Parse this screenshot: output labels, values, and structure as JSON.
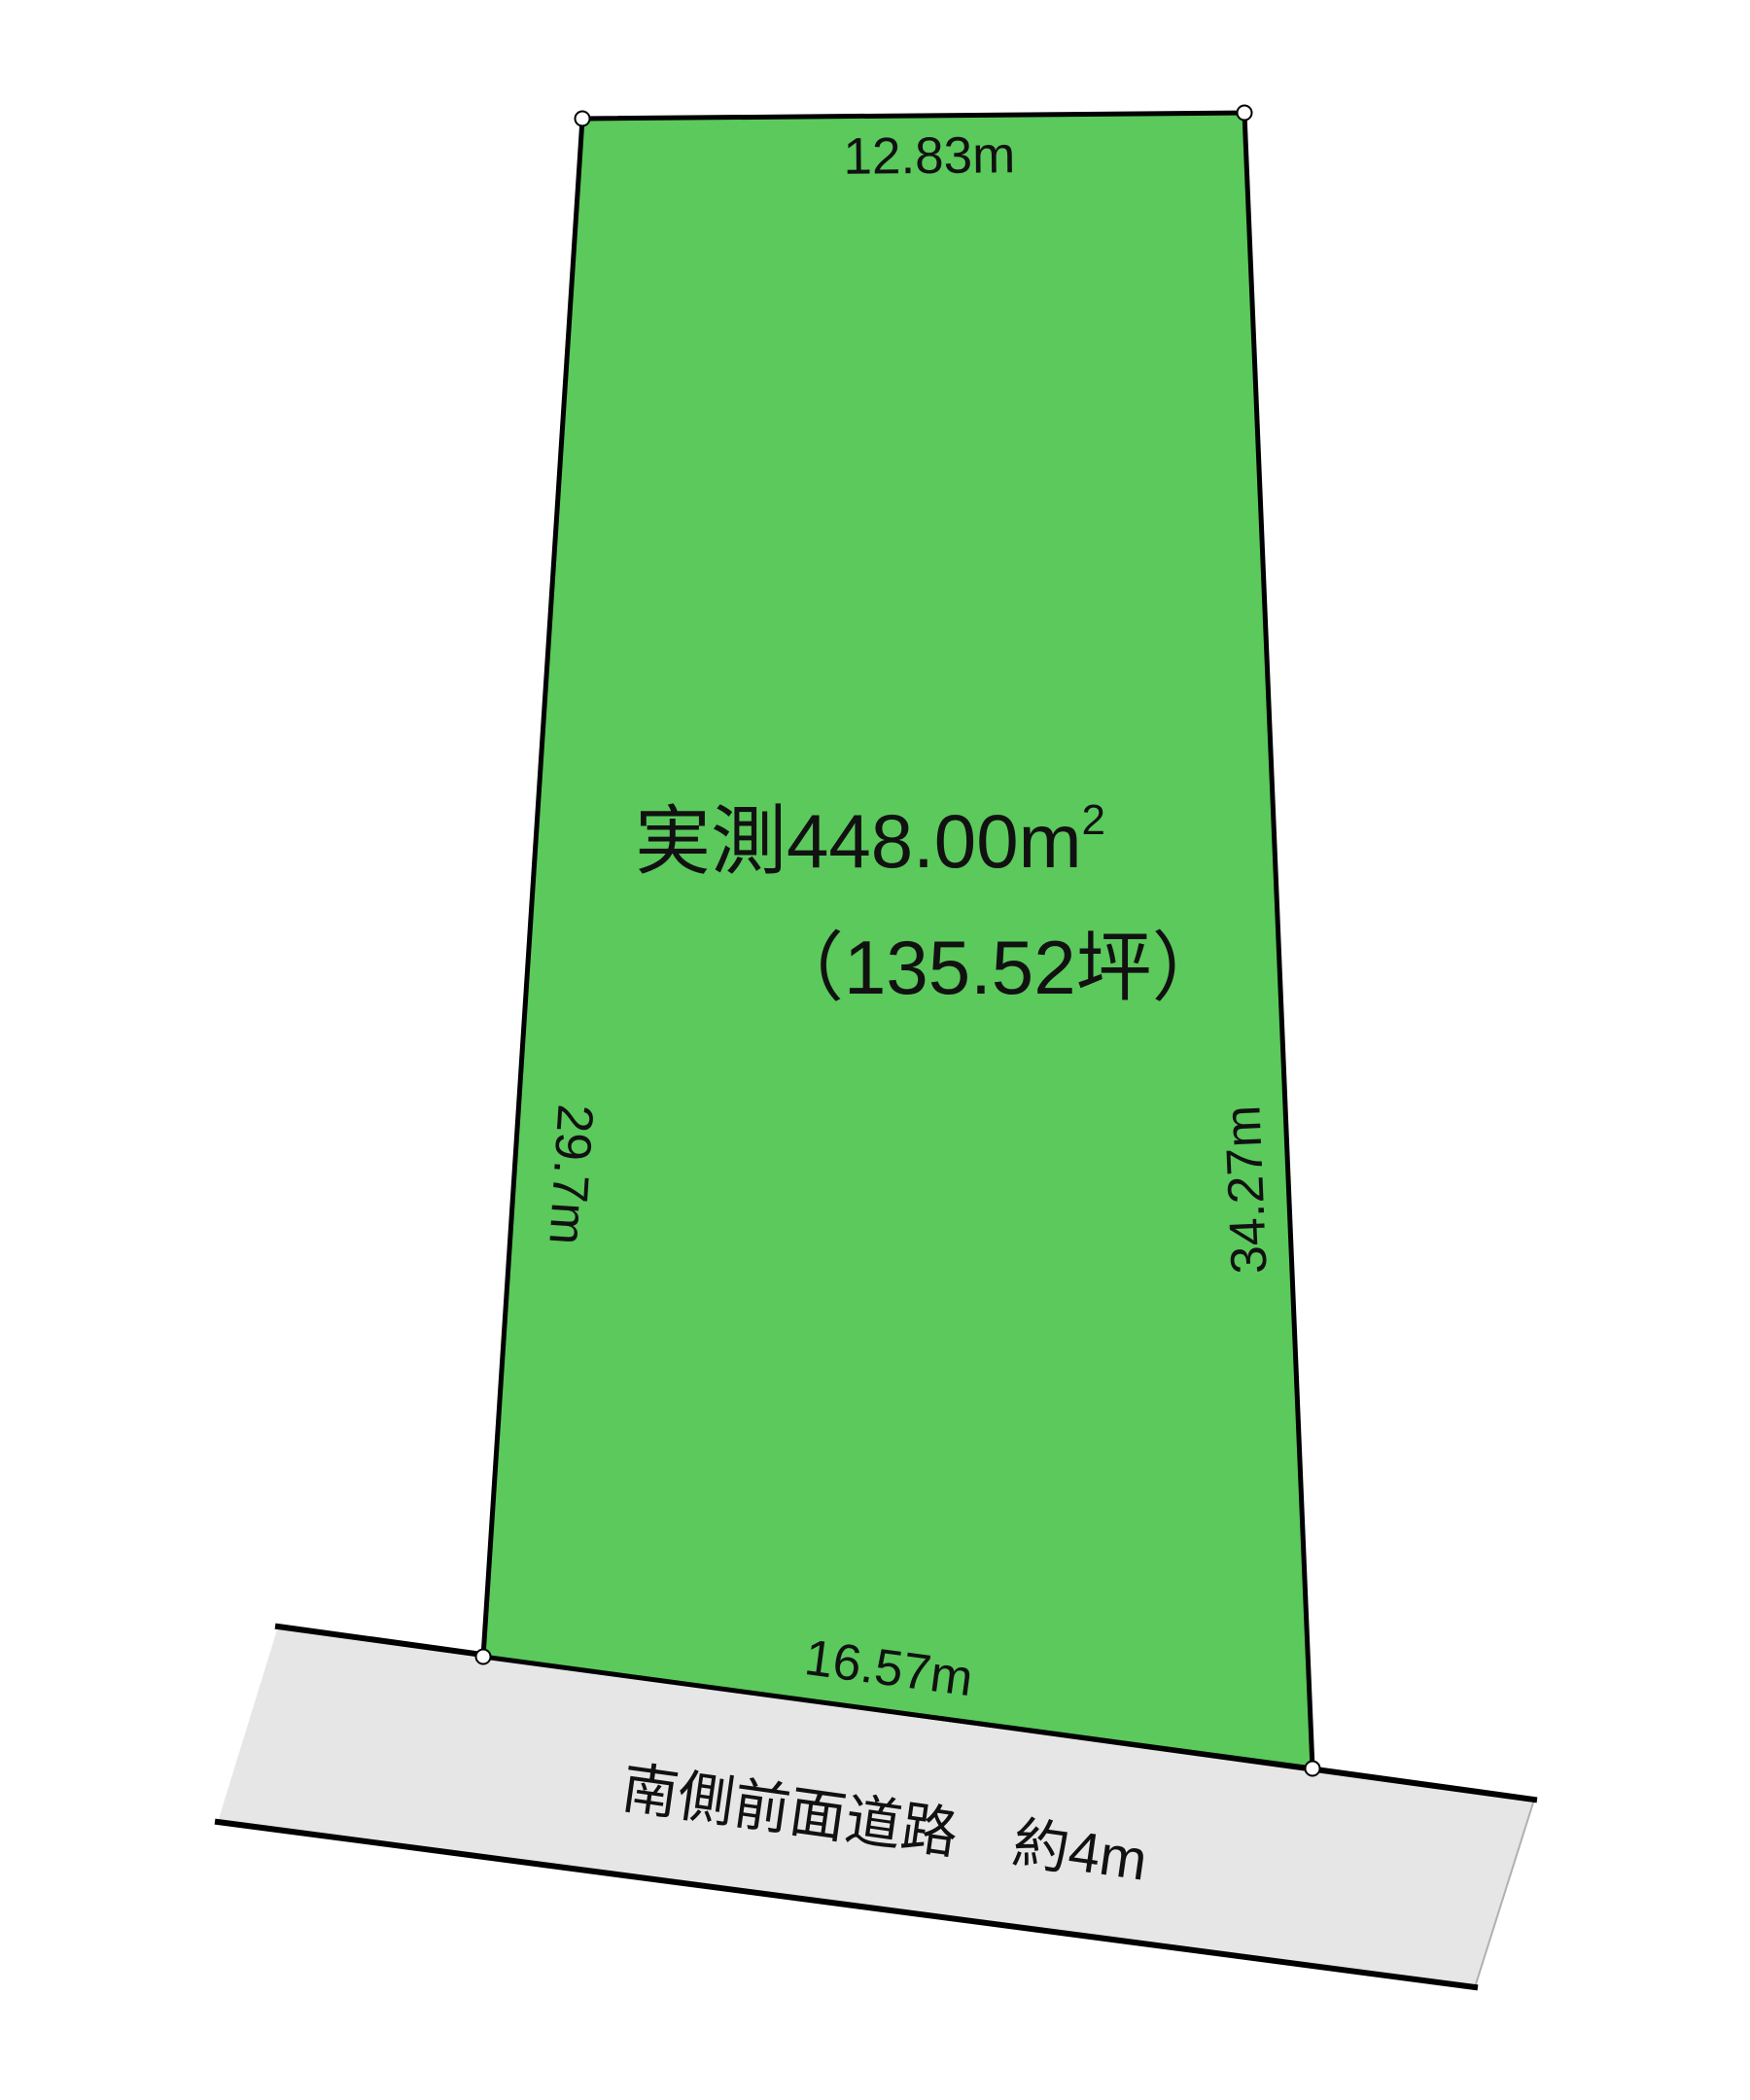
{
  "diagram": {
    "type_label": "land-plot-survey-diagram",
    "area_main": "実測448.00m",
    "area_sup": "2",
    "tsubo": "（135.52坪）",
    "dimensions": {
      "top": "12.83m",
      "left": "29.7m",
      "right": "34.27m",
      "bottom": "16.57m"
    },
    "road": {
      "label": "南側前面道路　約4m"
    }
  },
  "colors": {
    "land_fill": "#5bc95c",
    "land_stroke": "#000000",
    "road_fill": "#e6e6e6",
    "road_stroke": "#000000",
    "road_side_stroke": "#b0b0b0",
    "marker_fill": "#ffffff",
    "marker_stroke": "#000000",
    "text": "#111111",
    "background": "#ffffff"
  }
}
